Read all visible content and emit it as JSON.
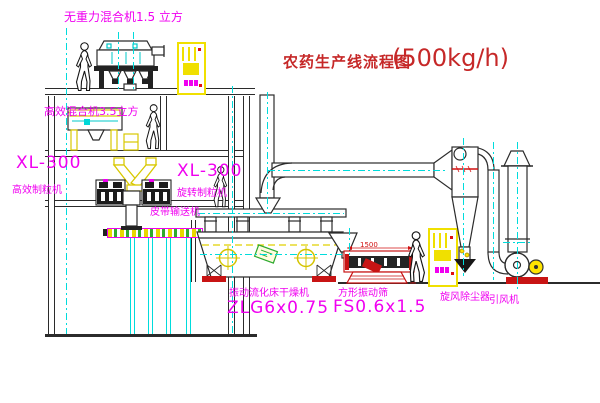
{
  "title": {
    "main": "农药生产线流程图",
    "capacity": "(500kg/h)"
  },
  "labels": {
    "mixer_top": "无重力混合机1.5 立方",
    "mixer_second": "高效混合机3.5立方",
    "granulator_left": {
      "model": "XL-300",
      "name": "高效制粒机"
    },
    "granulator_center": {
      "model": "XL-300",
      "name": "旋转制粒机"
    },
    "belt_conveyor": "皮带输送机",
    "dryer": {
      "name": "振动流化床干燥机",
      "model": "ZLG6x0.75"
    },
    "sieve": {
      "name": "方形振动筛",
      "model": "FS0.6x1.5"
    },
    "cyclone": "旋风除尘器",
    "fan": "引风机",
    "dimension_length": "1500"
  },
  "colors": {
    "label_magenta": "#f000f0",
    "title_red": "#c62828",
    "centerline_cyan": "#00dcdc",
    "equipment_yellow": "#f0e000",
    "line_dark": "#2b2b2b",
    "accent_red": "#d01010",
    "hatch_green": "#2faa2f"
  }
}
